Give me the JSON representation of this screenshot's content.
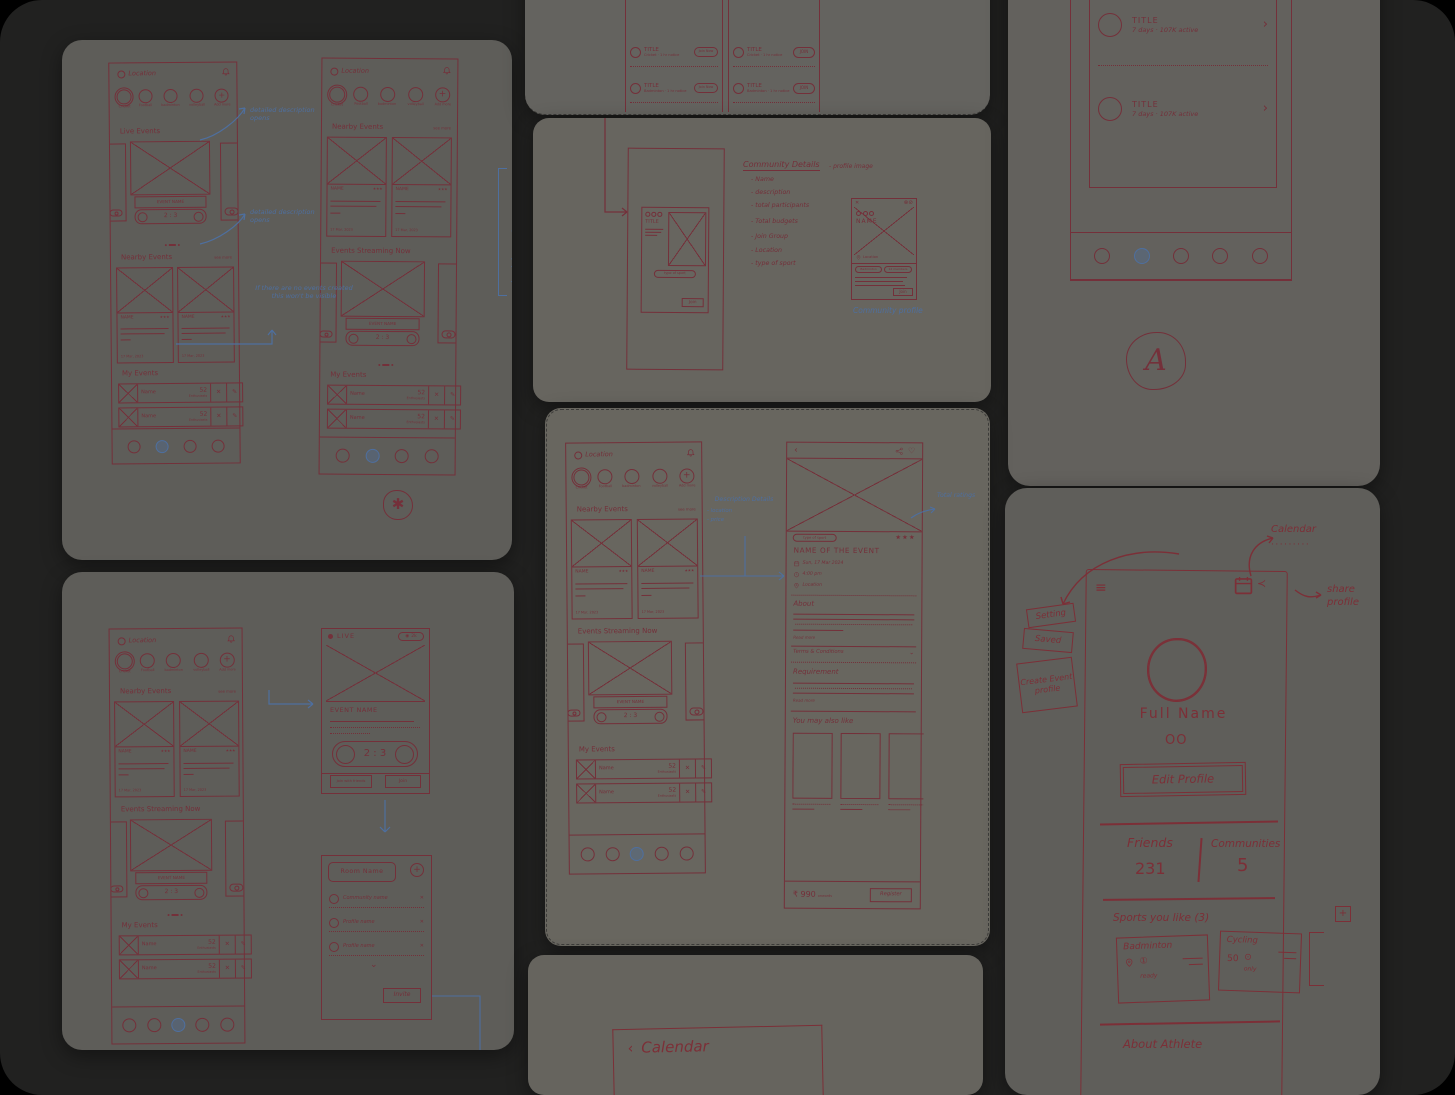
{
  "colors": {
    "background": "#212120",
    "card": "#63615d",
    "ink": "#74303a",
    "blue": "#4e6f9f"
  },
  "common": {
    "location": "Location",
    "sports": [
      "Cricket",
      "Football",
      "badminton",
      "volleyball",
      "Add more"
    ],
    "plus": "+",
    "live_events": "Live Events",
    "nearby_events": "Nearby Events",
    "see_more": "see more",
    "events_streaming": "Events Streaming Now",
    "my_events": "My Events",
    "event_name": "EVENT NAME",
    "score": "2 : 3",
    "name": "NAME",
    "stars": "★★★",
    "date": "17 Mar, 2023",
    "row_name": "Name",
    "row_count": "52",
    "row_sub": "Enthusiasts",
    "close": "✕",
    "pencil": "✎",
    "chevron_right": "›",
    "chevron_down": "⌄",
    "back": "‹",
    "heart": "♡",
    "signature": "✱",
    "signature_a": "A"
  },
  "annotations": {
    "detailed_1": "detailed description opens",
    "detailed_2": "detailed description opens",
    "no_events": "If there are no events created this won't be visible",
    "placement": "ordered placement",
    "description_details": "Description Details",
    "description_location": "- location",
    "description_price": "- price",
    "total_ratings": "Total ratings",
    "community_profile": "Community profile"
  },
  "join_list": {
    "title": "TITLE",
    "sub1": "Cricket · 1 hr notice",
    "sub2": "Badminton · 1 hr notice",
    "btn_left": "Join Now",
    "btn_right": "JOIN"
  },
  "community": {
    "heading": "Community Details",
    "bullets": [
      "Name",
      "description",
      "total participants",
      "Total budgets",
      "Join Group",
      "Location",
      "type of sport"
    ],
    "side_note": "profile image",
    "ooo": "OOO",
    "title": "TITLE",
    "type_pill": "type of sport",
    "join": "Join",
    "name": "NAME",
    "location": "Location",
    "pill1": "Badminton",
    "pill2": "12 members"
  },
  "title_list": {
    "title": "TITLE",
    "sub": "7 days · 107K active"
  },
  "event": {
    "type_pill": "type of sport",
    "title": "NAME OF THE EVENT",
    "date": "Sun, 17 Mar 2024",
    "time": "4:00 pm",
    "location": "Location",
    "about": "About",
    "read_more": "Read more",
    "terms": "Terms & Conditions",
    "requirement": "Requirement",
    "also_like": "You may also like",
    "price": "₹ 990",
    "price_sub": "onwards",
    "register": "Register"
  },
  "profile": {
    "menu": [
      "Setting",
      "Saved",
      "Create Event profile"
    ],
    "calendar": "Calendar",
    "dots": "·········",
    "share": "share profile",
    "full_name": "Full Name",
    "handles": "OO",
    "edit": "Edit Profile",
    "friends_label": "Friends",
    "friends_value": "231",
    "communities_label": "Communities",
    "communities_value": "5",
    "sports_heading": "Sports you like (3)",
    "sport1": "Badminton",
    "sport1_icon": "①",
    "sport1_note": "ready",
    "sport2": "Cycling",
    "sport2_value": "50",
    "sport2_icon": "⊙",
    "sport2_note": "only",
    "about": "About Athlete"
  },
  "live": {
    "label": "LIVE",
    "viewers": "2k",
    "join_friends": "Join with friends",
    "join": "Join"
  },
  "room": {
    "title": "Room Name",
    "rows": [
      "Community name",
      "Profile name",
      "Profile name"
    ],
    "invite": "Invite"
  },
  "calendar_card": {
    "title": "Calendar"
  }
}
